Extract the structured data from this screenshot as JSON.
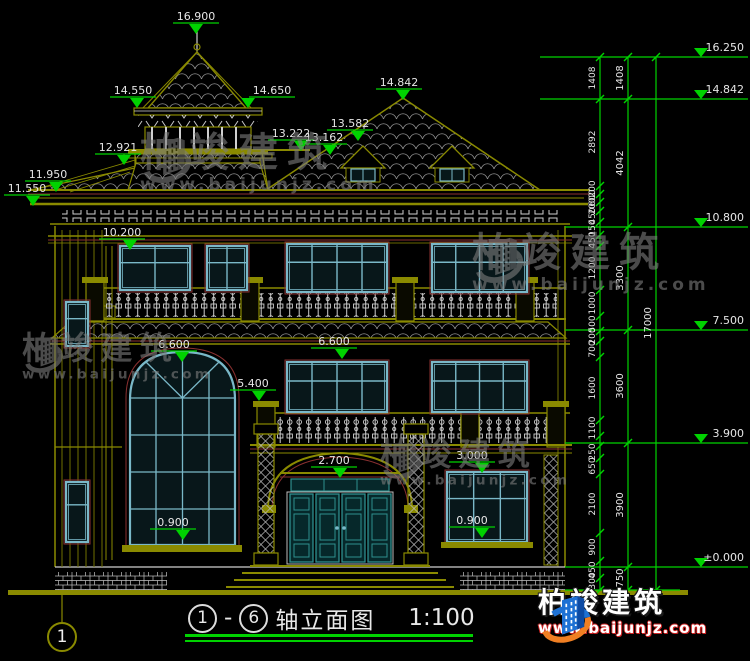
{
  "title": {
    "axis_start": "1",
    "separator": "-",
    "axis_end": "6",
    "name": "轴立面图",
    "scale": "1:100"
  },
  "axis_bubble": {
    "label": "1"
  },
  "watermark": {
    "brand": "柏竣建筑",
    "url": "www.baijunjz.com",
    "instances": [
      {
        "x": 140,
        "y": 132,
        "scale": 1.0
      },
      {
        "x": 472,
        "y": 232,
        "scale": 1.0
      },
      {
        "x": 22,
        "y": 332,
        "scale": 0.8
      },
      {
        "x": 380,
        "y": 438,
        "scale": 0.8
      }
    ]
  },
  "footer_logo": {
    "brand": "柏竣建筑",
    "url": "www.baijunjz.com"
  },
  "colors": {
    "green": "#00d200",
    "olive": "#8a8a00",
    "white": "#e6e6e6",
    "cyan": "#7ab8c8",
    "red": "#8a3030"
  },
  "elevation_markers": [
    {
      "label": "16.900",
      "x": 196,
      "y": 10,
      "tdx": 0
    },
    {
      "label": "14.550",
      "x": 133,
      "y": 84,
      "tdx": 4
    },
    {
      "label": "14.650",
      "x": 272,
      "y": 84,
      "tdx": -24
    },
    {
      "label": "12.921",
      "x": 118,
      "y": 141,
      "tdx": 6
    },
    {
      "label": "13.222",
      "x": 291,
      "y": 127,
      "tdx": 10
    },
    {
      "label": "13.162",
      "x": 324,
      "y": 131,
      "tdx": 6
    },
    {
      "label": "13.582",
      "x": 350,
      "y": 117,
      "tdx": 8
    },
    {
      "label": "11.950",
      "x": 48,
      "y": 168,
      "tdx": 8
    },
    {
      "label": "11.550",
      "x": 27,
      "y": 182,
      "tdx": 6
    },
    {
      "label": "14.842",
      "x": 399,
      "y": 76,
      "tdx": 4
    },
    {
      "label": "10.200",
      "x": 122,
      "y": 226,
      "tdx": 8
    },
    {
      "label": "6.600",
      "x": 174,
      "y": 338,
      "tdx": 8
    },
    {
      "label": "6.600",
      "x": 334,
      "y": 335,
      "tdx": 8
    },
    {
      "label": "5.400",
      "x": 253,
      "y": 377,
      "tdx": 6
    },
    {
      "label": "2.700",
      "x": 334,
      "y": 454,
      "tdx": 6
    },
    {
      "label": "3.000",
      "x": 472,
      "y": 449,
      "tdx": 10
    },
    {
      "label": "0.900",
      "x": 173,
      "y": 516,
      "tdx": 10
    },
    {
      "label": "0.900",
      "x": 472,
      "y": 514,
      "tdx": 10
    }
  ],
  "right_levels": [
    {
      "label": "16.250",
      "y": 57,
      "x1": 540
    },
    {
      "label": "14.842",
      "y": 99,
      "x1": 540
    },
    {
      "label": "10.800",
      "y": 227,
      "x1": 565
    },
    {
      "label": "7.500",
      "y": 330,
      "x1": 565
    },
    {
      "label": "3.900",
      "y": 443,
      "x1": 565
    },
    {
      "label": "±0.000",
      "y": 567,
      "x1": 565
    }
  ],
  "dim_chains": [
    {
      "x": 600,
      "fs": 9,
      "ticks": [
        57,
        99,
        186,
        194,
        202,
        211,
        222,
        235,
        246,
        290,
        316,
        331,
        341,
        357,
        420,
        436,
        446,
        458,
        474,
        533,
        561,
        578,
        590
      ],
      "labels": [
        {
          "t": "1408",
          "y": 78
        },
        {
          "t": "2892",
          "y": 142
        },
        {
          "t": "200",
          "y": 189
        },
        {
          "t": "600",
          "y": 198
        },
        {
          "t": "200",
          "y": 206
        },
        {
          "t": "450",
          "y": 216
        },
        {
          "t": "150",
          "y": 228
        },
        {
          "t": "450",
          "y": 240
        },
        {
          "t": "1200",
          "y": 268
        },
        {
          "t": "1000",
          "y": 303
        },
        {
          "t": "500",
          "y": 324
        },
        {
          "t": "200",
          "y": 336
        },
        {
          "t": "700",
          "y": 349
        },
        {
          "t": "1600",
          "y": 388
        },
        {
          "t": "1100",
          "y": 428
        },
        {
          "t": "250",
          "y": 452
        },
        {
          "t": "650",
          "y": 466
        },
        {
          "t": "2100",
          "y": 504
        },
        {
          "t": "900",
          "y": 547
        },
        {
          "t": "450",
          "y": 570
        },
        {
          "t": "300",
          "y": 581
        }
      ]
    },
    {
      "x": 628,
      "fs": 10,
      "ticks": [
        57,
        99,
        227,
        330,
        443,
        567,
        590
      ],
      "labels": [
        {
          "t": "1408",
          "y": 78
        },
        {
          "t": "4042",
          "y": 163
        },
        {
          "t": "3300",
          "y": 278
        },
        {
          "t": "3600",
          "y": 386
        },
        {
          "t": "3900",
          "y": 505
        },
        {
          "t": "750",
          "y": 578
        }
      ]
    },
    {
      "x": 656,
      "fs": 10,
      "ticks": [
        57,
        590
      ],
      "labels": [
        {
          "t": "17000",
          "y": 323
        }
      ]
    }
  ],
  "windows": [
    {
      "x": 120,
      "y": 246,
      "w": 70,
      "h": 44,
      "c": 2
    },
    {
      "x": 207,
      "y": 246,
      "w": 40,
      "h": 44,
      "c": 2
    },
    {
      "x": 287,
      "y": 244,
      "w": 100,
      "h": 48,
      "c": 4
    },
    {
      "x": 432,
      "y": 244,
      "w": 95,
      "h": 48,
      "c": 4
    },
    {
      "x": 287,
      "y": 362,
      "w": 100,
      "h": 50,
      "c": 4
    },
    {
      "x": 432,
      "y": 362,
      "w": 95,
      "h": 50,
      "c": 4
    },
    {
      "x": 447,
      "y": 472,
      "w": 80,
      "h": 70,
      "c": 3,
      "sill": true
    },
    {
      "x": 66,
      "y": 302,
      "w": 22,
      "h": 44,
      "c": 1
    },
    {
      "x": 66,
      "y": 482,
      "w": 22,
      "h": 60,
      "c": 1
    }
  ]
}
